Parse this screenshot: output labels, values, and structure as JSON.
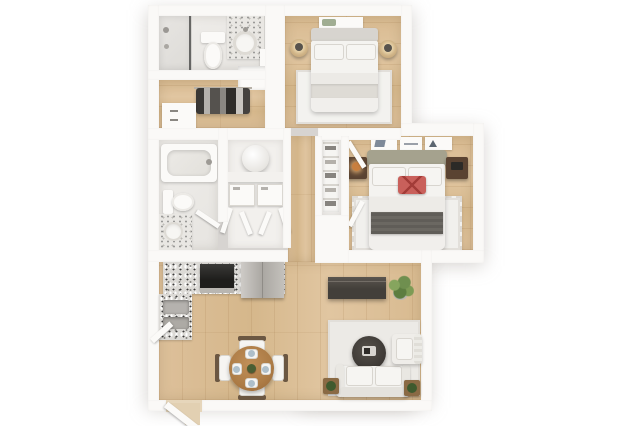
{
  "meta": {
    "type": "3d-floor-plan-rendering",
    "view": "top-down",
    "description": "3D rendered floor plan of a two-bedroom, two-bathroom apartment with open kitchen, dining and living area",
    "background_color": "#ffffff"
  },
  "palette": {
    "wall": "#faf9f7",
    "wood_floor": "#d8ba90",
    "tile_floor": "#ece9e5",
    "granite_counter": "#dcdad6",
    "stove": "#211f1d",
    "fridge_steel": "#b9b6b1",
    "headboard_olive": "#a5a28e",
    "accent_pillow_red": "#c9605b",
    "throw_blanket_gray": "#5f5c57",
    "nightstand_wood": "#5a4332",
    "dining_table_wood": "#b5834f",
    "tv_console": "#4a4540",
    "plant_green": "#6f8f4f",
    "rug": "#eceae6"
  },
  "rooms": [
    {
      "id": "bathroom-top",
      "label": "Bathroom 1",
      "furniture": [
        "walk-in shower with glass panel",
        "toilet",
        "granite vanity with sink",
        "linen niche"
      ]
    },
    {
      "id": "closet-top",
      "label": "Closet",
      "furniture": [
        "hanging clothes on rod",
        "white dresser"
      ]
    },
    {
      "id": "bedroom-2",
      "label": "Bedroom 2",
      "furniture": [
        "double bed with white bedding",
        "wall art",
        "two round nightstands with lamps",
        "white area rug"
      ]
    },
    {
      "id": "bathroom-hall",
      "label": "Bathroom 2",
      "furniture": [
        "bathtub",
        "toilet",
        "granite vanity"
      ]
    },
    {
      "id": "laundry-closet",
      "label": "Laundry closet",
      "furniture": [
        "water heater",
        "washer",
        "dryer",
        "open bifold doors"
      ]
    },
    {
      "id": "hallway",
      "label": "Hallway",
      "furniture": []
    },
    {
      "id": "closet-primary",
      "label": "Primary closet",
      "furniture": [
        "shelving with folded items",
        "open closet doors"
      ]
    },
    {
      "id": "bedroom-primary",
      "label": "Primary bedroom",
      "furniture": [
        "queen bed with white bedding",
        "olive headboard",
        "red accent pillow",
        "gray throw blanket",
        "three picture frames",
        "two dark wood nightstands",
        "cream area rug"
      ]
    },
    {
      "id": "kitchen",
      "label": "Kitchen",
      "furniture": [
        "L-shaped granite counter",
        "black range",
        "stainless refrigerator",
        "double basin sink"
      ]
    },
    {
      "id": "dining-area",
      "label": "Dining area",
      "furniture": [
        "round wood table",
        "four chairs",
        "four place settings",
        "centerpiece"
      ]
    },
    {
      "id": "living-room",
      "label": "Living room",
      "furniture": [
        "dark tv console",
        "potted plant",
        "light area rug",
        "round dark coffee table with tray",
        "white sofa",
        "white armchair",
        "two plant side tables"
      ]
    },
    {
      "id": "entry",
      "label": "Entry",
      "furniture": [
        "open entry door"
      ]
    }
  ]
}
